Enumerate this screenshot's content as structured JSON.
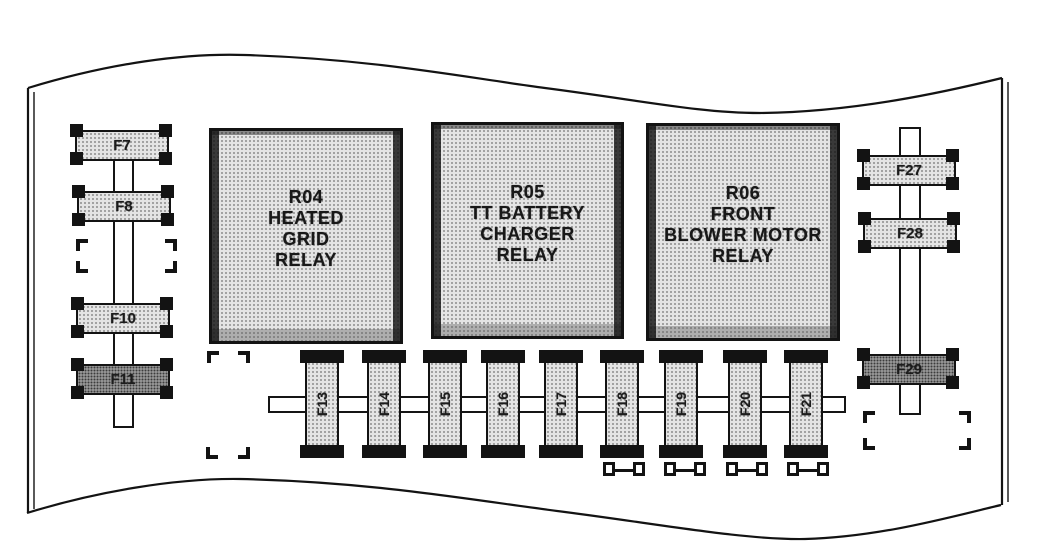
{
  "diagram": {
    "type": "fuse-box-diagram",
    "relays": [
      {
        "id": "R04",
        "line1": "R04",
        "line2": "HEATED",
        "line3": "GRID",
        "line4": "RELAY"
      },
      {
        "id": "R05",
        "line1": "R05",
        "line2": "TT BATTERY",
        "line3": "CHARGER",
        "line4": "RELAY"
      },
      {
        "id": "R06",
        "line1": "R06",
        "line2": "FRONT",
        "line3": "BLOWER MOTOR",
        "line4": "RELAY"
      }
    ],
    "left_fuses": [
      {
        "label": "F7"
      },
      {
        "label": "F8"
      },
      {
        "label": "F10"
      },
      {
        "label": "F11"
      }
    ],
    "right_fuses": [
      {
        "label": "F27"
      },
      {
        "label": "F28"
      },
      {
        "label": "F29"
      }
    ],
    "bottom_fuses": [
      {
        "label": "F13"
      },
      {
        "label": "F14"
      },
      {
        "label": "F15"
      },
      {
        "label": "F16"
      },
      {
        "label": "F17"
      },
      {
        "label": "F18"
      },
      {
        "label": "F19"
      },
      {
        "label": "F20"
      },
      {
        "label": "F21"
      }
    ],
    "colors": {
      "line": "#131313",
      "fuse_fill": "#e4e4e4",
      "fuse_fill_dark": "#a6a6a6",
      "relay_fill": "#dcdcdc",
      "background": "#ffffff"
    }
  }
}
